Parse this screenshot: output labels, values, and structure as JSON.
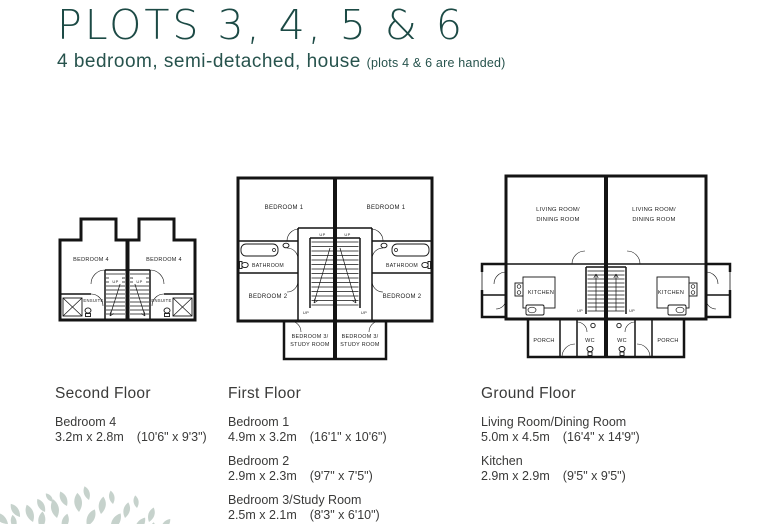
{
  "header": {
    "title": "PLOTS 3, 4, 5 & 6",
    "subtitle": "4 bedroom, semi-detached, house",
    "note": "(plots 4 & 6 are handed)"
  },
  "colors": {
    "accent": "#1c4a45",
    "body_text": "#3a3a39",
    "wall": "#141414",
    "leaf": "#c6d2cc"
  },
  "plans": {
    "second_floor": {
      "bedroom4": "BEDROOM 4",
      "ensuite": "ENSUITE",
      "up": "UP"
    },
    "first_floor": {
      "bedroom1": "BEDROOM 1",
      "bathroom": "BATHROOM",
      "bedroom2": "BEDROOM 2",
      "bedroom3_line1": "BEDROOM 3/",
      "bedroom3_line2": "STUDY ROOM",
      "up": "UP"
    },
    "ground_floor": {
      "living_line1": "LIVING ROOM/",
      "living_line2": "DINING ROOM",
      "kitchen": "KITCHEN",
      "wc": "WC",
      "porch": "PORCH",
      "up": "UP"
    }
  },
  "legend": {
    "second_floor": {
      "heading": "Second Floor",
      "items": [
        {
          "name": "Bedroom 4",
          "metric": "3.2m x 2.8m",
          "imperial": "(10'6\" x 9'3\")"
        }
      ]
    },
    "first_floor": {
      "heading": "First Floor",
      "items": [
        {
          "name": "Bedroom 1",
          "metric": "4.9m x 3.2m",
          "imperial": "(16'1\" x 10'6\")"
        },
        {
          "name": "Bedroom 2",
          "metric": "2.9m x 2.3m",
          "imperial": "(9'7\" x 7'5\")"
        },
        {
          "name": "Bedroom 3/Study Room",
          "metric": "2.5m x 2.1m",
          "imperial": "(8'3\" x 6'10\")"
        }
      ]
    },
    "ground_floor": {
      "heading": "Ground Floor",
      "items": [
        {
          "name": "Living Room/Dining Room",
          "metric": "5.0m x 4.5m",
          "imperial": "(16'4\" x 14'9\")"
        },
        {
          "name": "Kitchen",
          "metric": "2.9m x 2.9m",
          "imperial": "(9'5\" x 9'5\")"
        }
      ]
    }
  }
}
